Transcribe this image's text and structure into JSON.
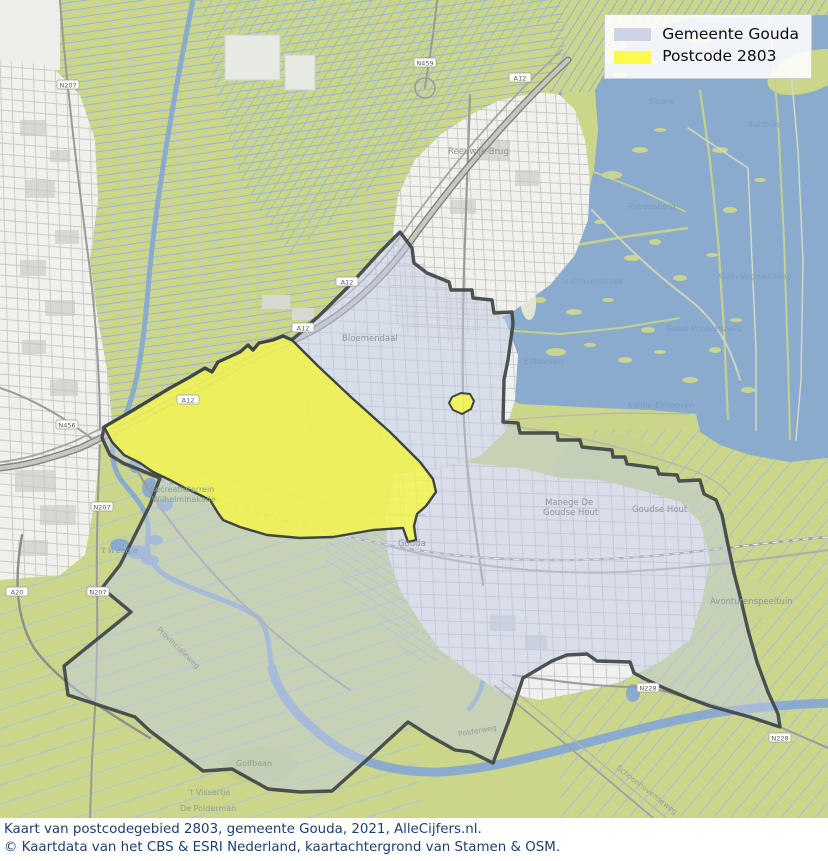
{
  "legend": {
    "items": [
      {
        "label": "Gemeente Gouda",
        "swatch_color": "#cdd4e6"
      },
      {
        "label": "Postcode 2803",
        "swatch_color": "#fbfb4f"
      }
    ]
  },
  "caption": {
    "line1": "Kaart van postcodegebied 2803, gemeente Gouda, 2021, AlleCijfers.nl.",
    "line2": "© Kaartdata van het CBS & ESRI Nederland, kaartachtergrond van Stamen & OSM."
  },
  "map": {
    "labels": [
      {
        "text": "Bloemendaal"
      },
      {
        "text": "Recreatieterrein"
      },
      {
        "text": "Wilhelminakade"
      },
      {
        "text": "Manege De"
      },
      {
        "text": "Goudse Hout"
      },
      {
        "text": "Goudse Hout"
      },
      {
        "text": "Gouda"
      },
      {
        "text": "Avonturenspeeltuin"
      },
      {
        "text": "Sloene"
      },
      {
        "text": "Surfplas"
      },
      {
        "text": "Ravensberg"
      },
      {
        "text": "'s-Gravenbroek"
      },
      {
        "text": "Klein Vogelenzang"
      },
      {
        "text": "Groot Vogelenzang"
      },
      {
        "text": "Elfhoeven"
      },
      {
        "text": "Kleine Elfhoeven"
      },
      {
        "text": "'t Weegje"
      },
      {
        "text": "Golfbaan"
      },
      {
        "text": "'t Vissertje"
      },
      {
        "text": "De Polderman"
      },
      {
        "text": "Schoonhovenseweg"
      },
      {
        "text": "Polderweg"
      },
      {
        "text": "Provincialeweg"
      },
      {
        "text": "Reeuwijk-Brug"
      }
    ],
    "shields": [
      {
        "text": "A12"
      },
      {
        "text": "A12"
      },
      {
        "text": "A12"
      },
      {
        "text": "A12"
      },
      {
        "text": "N207"
      },
      {
        "text": "N207"
      },
      {
        "text": "N207"
      },
      {
        "text": "N456"
      },
      {
        "text": "A20"
      },
      {
        "text": "N228"
      },
      {
        "text": "N228"
      },
      {
        "text": "N459"
      }
    ],
    "colors": {
      "field": "#cbd68b",
      "water": "#8aabce",
      "urban": "#f0f0ec",
      "municipality_fill": "#c1cbe2",
      "municipality_outline": "#3f4444",
      "postcode_fill": "#f6f746",
      "caption_text": "#1d3f72"
    }
  }
}
